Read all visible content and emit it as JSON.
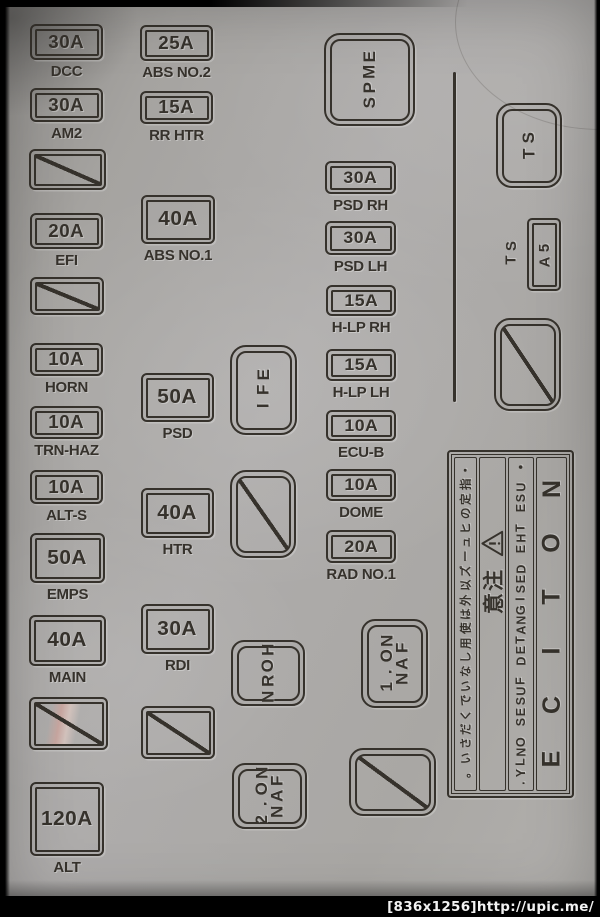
{
  "photo": {
    "watermark": "[836x1256]http://upic.me/"
  },
  "colors": {
    "plastic": "#aaa8a5",
    "engraving": "#36322c",
    "frame": "#000000",
    "watermark_text": "#f2f2f2"
  },
  "fuses": {
    "col1": [
      {
        "amp": "30A",
        "label": "DCC"
      },
      {
        "amp": "30A",
        "label": "AM2"
      },
      {
        "blank": true
      },
      {
        "amp": "20A",
        "label": "EFI"
      },
      {
        "blank": true
      },
      {
        "amp": "10A",
        "label": "HORN"
      },
      {
        "amp": "10A",
        "label": "TRN-HAZ"
      },
      {
        "amp": "10A",
        "label": "ALT-S"
      },
      {
        "amp": "50A",
        "label": "EMPS"
      },
      {
        "amp": "40A",
        "label": "MAIN"
      },
      {
        "blank": true
      },
      {
        "amp": "120A",
        "label": "ALT"
      }
    ],
    "col2": [
      {
        "amp": "25A",
        "label": "ABS NO.2"
      },
      {
        "amp": "15A",
        "label": "RR HTR"
      },
      {
        "amp": "40A",
        "label": "ABS NO.1"
      },
      {
        "amp": "50A",
        "label": "PSD"
      },
      {
        "amp": "40A",
        "label": "HTR"
      },
      {
        "amp": "30A",
        "label": "RDI"
      },
      {
        "blank": true
      }
    ],
    "col4": [
      {
        "amp": "30A",
        "label": "PSD RH"
      },
      {
        "amp": "30A",
        "label": "PSD LH"
      },
      {
        "amp": "15A",
        "label": "H-LP RH"
      },
      {
        "amp": "15A",
        "label": "H-LP LH"
      },
      {
        "amp": "10A",
        "label": "ECU-B"
      },
      {
        "amp": "10A",
        "label": "DOME"
      },
      {
        "amp": "20A",
        "label": "RAD NO.1"
      }
    ],
    "st_small": {
      "amp": "5A",
      "label": "ST"
    }
  },
  "relays": {
    "emps": "EMPS",
    "efi": "EFI",
    "horn": "HORN",
    "st": "ST",
    "fan1": [
      "FAN",
      "NO.1"
    ],
    "fan2": [
      "FAN",
      "NO.2"
    ]
  },
  "notice": {
    "title": "NOTICE",
    "line_en": "• USE THE DESIGNATED FUSES ONLY.",
    "caution_kanji": "注意",
    "line_jp": "・指定のヒューズ以外は使用しないでください。"
  }
}
